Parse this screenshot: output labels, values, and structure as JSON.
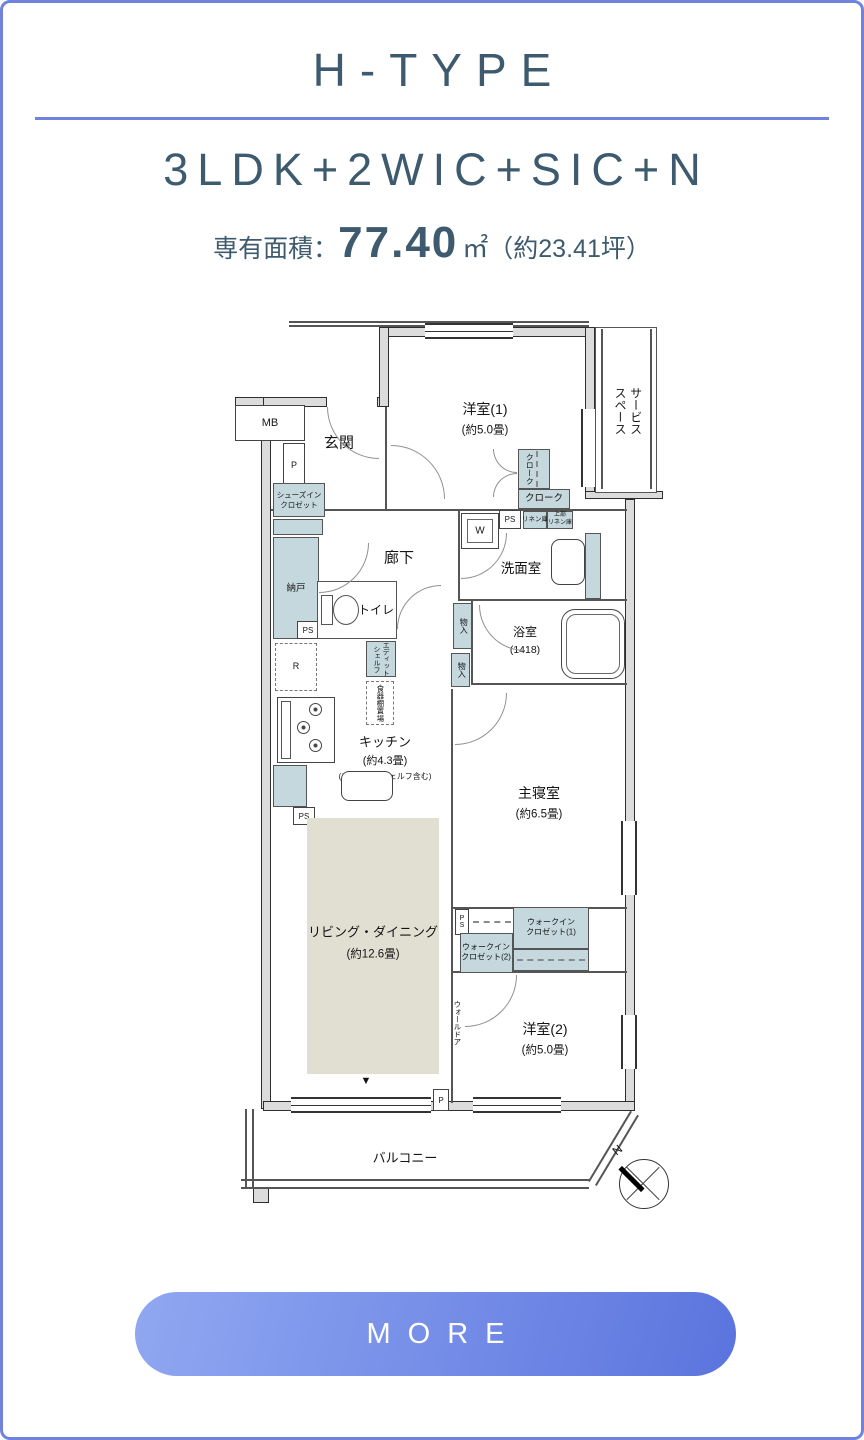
{
  "header": {
    "title": "H-TYPE",
    "layout": "3LDK+2WIC+SIC+N",
    "area_label": "専有面積：",
    "area_value": "77.40",
    "area_unit": "㎡",
    "area_tsubo": "（約23.41坪）"
  },
  "colors": {
    "accent_blue": "#6f82dd",
    "heading_text": "#3d5a6e",
    "closet_blue": "#c5d8de",
    "living_beige": "#e1ded2",
    "button_gradient_start": "#90a8f1",
    "button_gradient_end": "#5b74de"
  },
  "floorplan": {
    "mb": "MB",
    "p": "P",
    "ps": "PS",
    "ps_vert": "P\nS",
    "genkan": "玄関",
    "yoshitsu1": "洋室(1)",
    "yoshitsu1_size": "(約5.0畳)",
    "service_space": "サービス\nスペース",
    "cloak": "クローク",
    "linen": "リネン庫",
    "upper_linen": "上部\nリネン庫",
    "w": "W",
    "senmen": "洗面室",
    "shoes_closet": "シューズイン\nクロゼット",
    "nando": "納戸",
    "rouka": "廊下",
    "toilet": "トイレ",
    "monoire": "物入",
    "yokushitsu": "浴室",
    "yokushitsu_size": "(1418)",
    "r": "R",
    "edit_shelf": "エディット\nシェルフ",
    "dish_shelf": "食器棚置場",
    "kitchen": "キッチン",
    "kitchen_size": "(約4.3畳)",
    "kitchen_note": "(エディットシェルフ含む)",
    "counter": "カウンター",
    "master": "主寝室",
    "master_size": "(約6.5畳)",
    "living": "リビング・ダイニング",
    "living_size": "(約12.6畳)",
    "wic1": "ウォークイン\nクロゼット(1)",
    "wic2": "ウォークイン\nクロゼット(2)",
    "wall_door": "ウォールドア",
    "yoshitsu2": "洋室(2)",
    "yoshitsu2_size": "(約5.0畳)",
    "balcony": "バルコニー",
    "marker": "▼",
    "compass_n": "N"
  },
  "more": {
    "label": "MORE"
  }
}
